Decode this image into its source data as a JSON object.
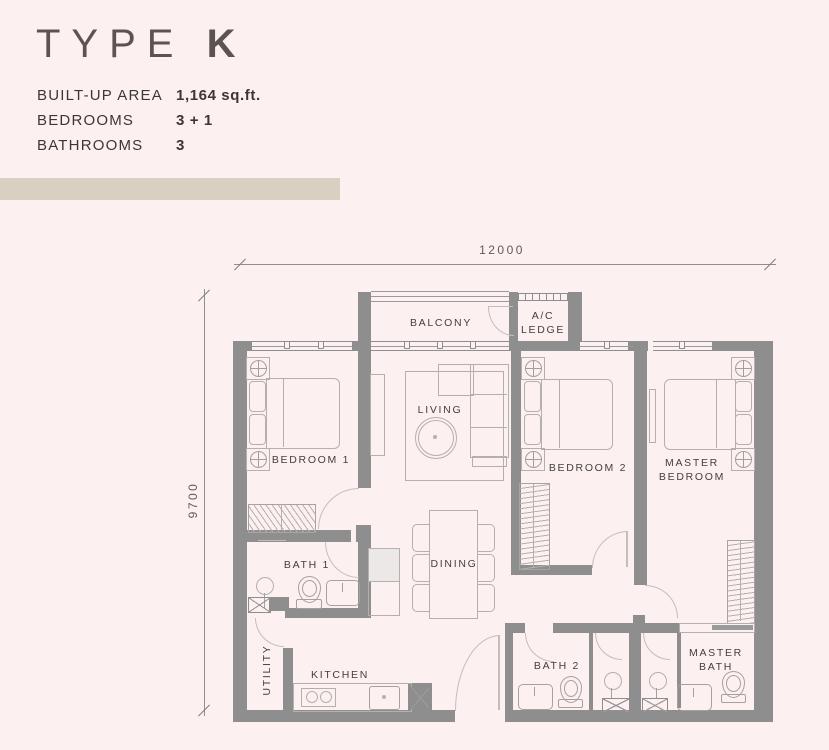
{
  "colors": {
    "background": "#fcf1f0",
    "wall": "#8e8e8e",
    "accent_bar": "#d8d1c1",
    "heading_text": "#5c5452",
    "body_text": "#3c3734",
    "furniture_line": "#b4b0ae"
  },
  "header": {
    "title_word": "TYPE",
    "title_letter": "K",
    "specs": [
      {
        "label": "BUILT-UP AREA",
        "value": "1,164 sq.ft."
      },
      {
        "label": "BEDROOMS",
        "value": "3 + 1"
      },
      {
        "label": "BATHROOMS",
        "value": "3"
      }
    ]
  },
  "dimensions": {
    "top": "12000",
    "left": "9700"
  },
  "rooms": {
    "balcony": "BALCONY",
    "ac_ledge_line1": "A/C",
    "ac_ledge_line2": "LEDGE",
    "living": "LIVING",
    "bedroom1": "BEDROOM 1",
    "bedroom2": "BEDROOM 2",
    "master_bedroom_line1": "MASTER",
    "master_bedroom_line2": "BEDROOM",
    "bath1": "BATH 1",
    "bath2": "BATH 2",
    "master_bath_line1": "MASTER",
    "master_bath_line2": "BATH",
    "dining": "DINING",
    "kitchen": "KITCHEN",
    "utility": "UTILITY"
  }
}
